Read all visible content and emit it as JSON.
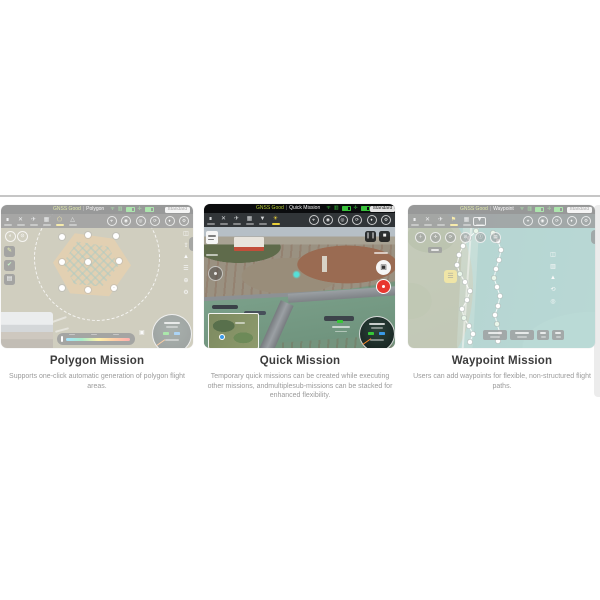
{
  "page": {
    "background": "#ffffff",
    "divider_color": "#c6c6c6"
  },
  "cards": [
    {
      "id": "polygon",
      "title": "Polygon Mission",
      "description": "Supports one-click automatic generation of polygon flight areas.",
      "status_text": "GNSS Good",
      "mission_label": "Polygon",
      "mode_chip": "Standard",
      "faded": true
    },
    {
      "id": "quick",
      "title": "Quick Mission",
      "description": "Temporary quick missions can be created while executing other missions, andmultiplesub-missions can be stacked for enhanced flexibility.",
      "status_text": "GNSS Good",
      "mission_label": "Quick Mission",
      "mode_chip": "Standard",
      "faded": false
    },
    {
      "id": "waypoint",
      "title": "Waypoint Mission",
      "description": "Users can add waypoints for flexible, non-structured flight paths.",
      "status_text": "GNSS Good",
      "mission_label": "Waypoint",
      "mode_chip": "Standard",
      "faded": true
    }
  ],
  "colors": {
    "highlight_yellow": "#e9cf39",
    "status_green": "#39c23c",
    "record_red": "#e8372f",
    "water_teal": "#4f9a92",
    "polygon_fill": "#de9330"
  },
  "waypoint_screenshot": {
    "chains": [
      {
        "points": [
          [
            68,
            26
          ],
          [
            61,
            33
          ],
          [
            55,
            41
          ],
          [
            51,
            50
          ],
          [
            49,
            60
          ],
          [
            52,
            69
          ],
          [
            57,
            77
          ],
          [
            62,
            86
          ],
          [
            59,
            95
          ],
          [
            54,
            104
          ],
          [
            56,
            113
          ],
          [
            61,
            121
          ],
          [
            65,
            129
          ],
          [
            62,
            137
          ]
        ]
      },
      {
        "points": [
          [
            85,
            28
          ],
          [
            90,
            36
          ],
          [
            93,
            45
          ],
          [
            91,
            55
          ],
          [
            88,
            64
          ],
          [
            86,
            73
          ],
          [
            89,
            82
          ],
          [
            92,
            91
          ],
          [
            90,
            101
          ],
          [
            87,
            110
          ],
          [
            89,
            119
          ],
          [
            92,
            128
          ],
          [
            90,
            136
          ]
        ]
      }
    ]
  }
}
